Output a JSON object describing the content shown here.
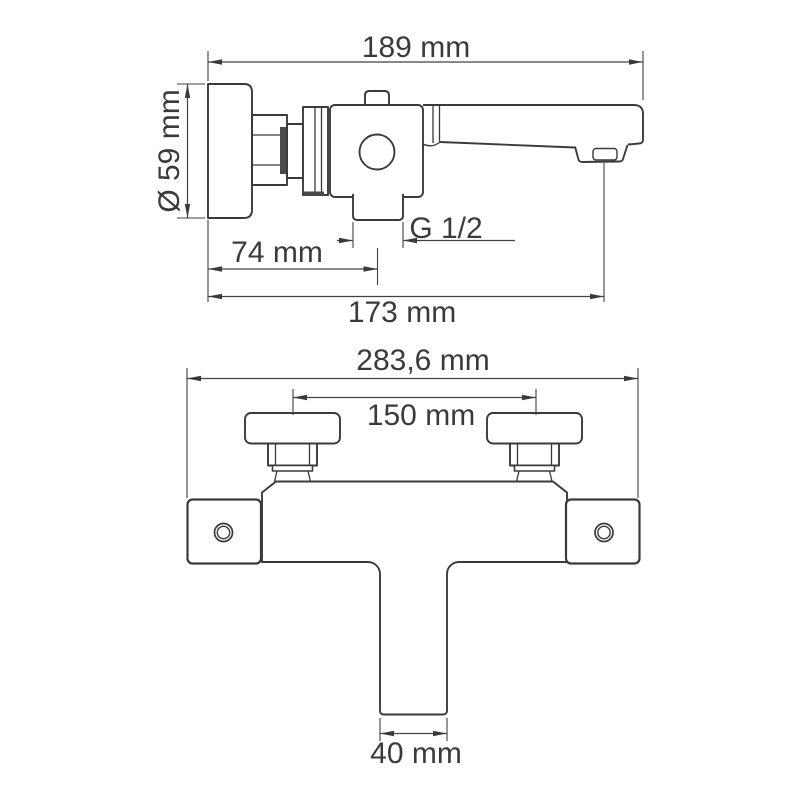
{
  "colors": {
    "background": "#ffffff",
    "lines": "#3a3a3c",
    "text": "#3a3a3c"
  },
  "side_view": {
    "overall_length": "189 mm",
    "flange_diameter": "Ø 59 mm",
    "outlet_thread": "G 1/2",
    "wall_to_outlet_center": "74 mm",
    "wall_to_spout_outlet": "173 mm"
  },
  "front_view": {
    "overall_width": "283,6 mm",
    "mounting_centers": "150 mm",
    "spout_width": "40 mm"
  }
}
